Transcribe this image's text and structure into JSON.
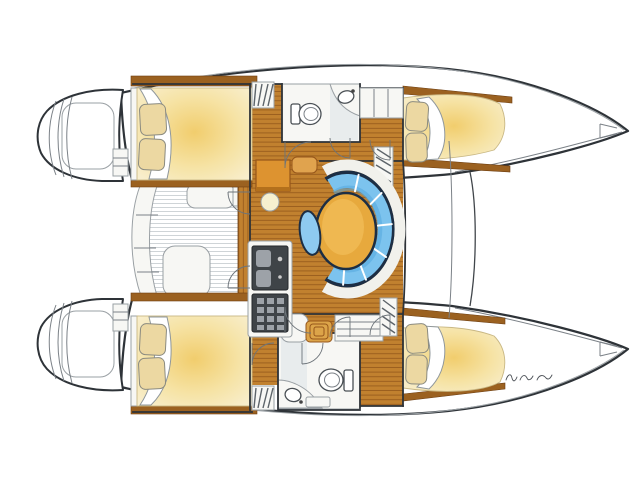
{
  "canvas": {
    "width": 640,
    "height": 480,
    "background": "#ffffff"
  },
  "document": {
    "type": "catamaran interior deck plan",
    "orientation": "bow-right, sterns-left"
  },
  "palette": {
    "outline": "#2e3338",
    "line": "#9aa0a4",
    "wood": "#c1812f",
    "wood_grain": "#8a5016",
    "wood_dark": "#9b6120",
    "bed_glow": "#f1cd6d",
    "bed_mid": "#f6e3a5",
    "bed_pale": "#f8efd0",
    "pillow": "#ecd8a2",
    "settee_navy": "#1c2e44",
    "settee_blue": "#7cc3ee",
    "settee_blue_deep": "#54a7df",
    "table_orange": "#e7a93d",
    "table_rim": "#96561a",
    "seat_orange": "#e0a34e",
    "stool_blue": "#8ecaf0",
    "appliance": "#3f4448",
    "appliance_cell": "#9da2a8",
    "cabinet": "#f7f7f4",
    "steps_tan": "#dca449",
    "shade": "#e4e8eb",
    "slat": "#c3c9cd",
    "background": "#ffffff"
  },
  "features": [
    "two hulls with stepped transom platforms aft (left)",
    "aft cockpit with slatted sole, curved bench and seats",
    "central saloon with oval dining table, wrap-around blue settee and oval stool",
    "linear galley with twin sink, stove and counters",
    "chart table with seat and round stool",
    "one head per hull with marine toilet and curved basin counter",
    "four double cabins (fore and aft in each hull) with pillows and turned-down duvets",
    "companionway steps and door swings between saloon, hulls and heads",
    "forward crossbeam between the bows",
    "illegible handwritten designer signature near starboard bow"
  ],
  "signature": {
    "present": true,
    "legible": false
  }
}
